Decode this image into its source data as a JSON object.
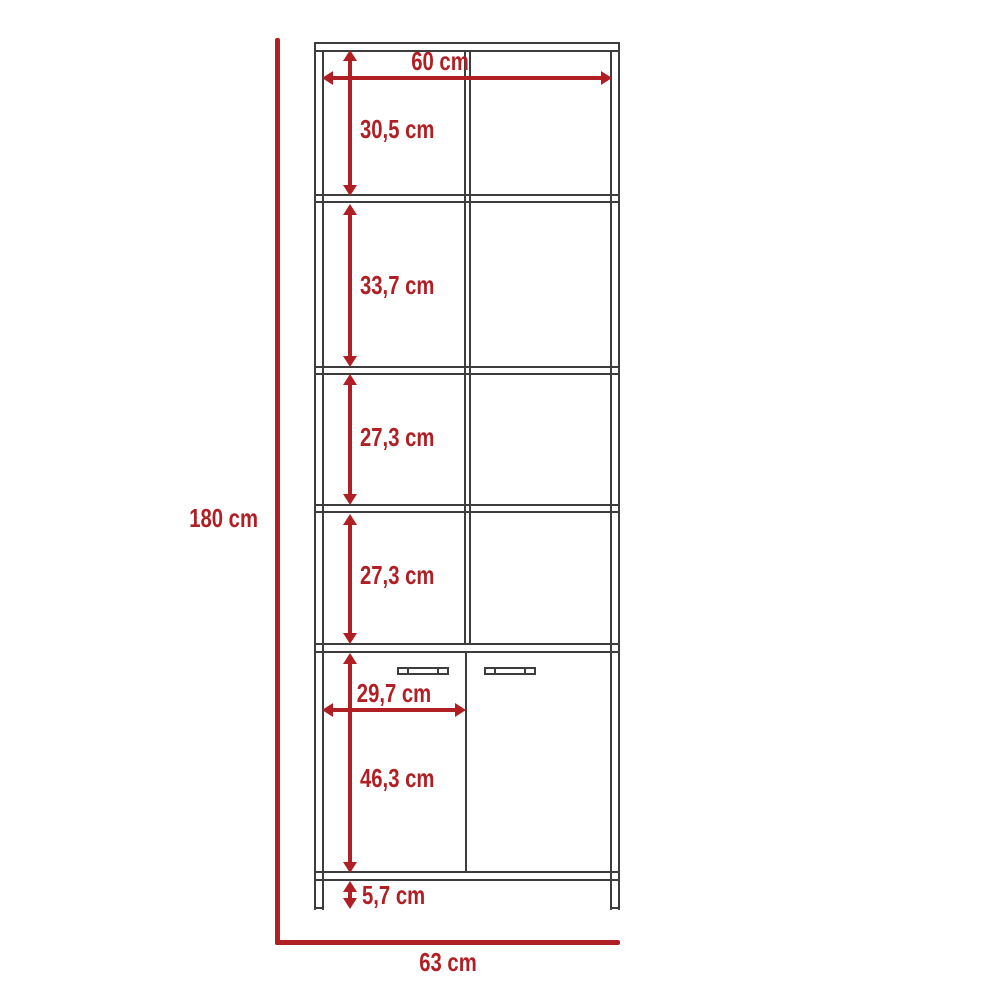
{
  "diagram": {
    "type": "furniture-dimension-drawing",
    "subject": "tall bookcase with four open shelf compartments and a two-door base cabinet on legs",
    "units": "cm",
    "accent_color": "#b01f24",
    "line_color": "#3d3d3d",
    "dimensions": {
      "overall_height": "180 cm",
      "overall_width": "63 cm",
      "inner_width": "60 cm",
      "compartment_1_height": "30,5 cm",
      "compartment_2_height": "33,7 cm",
      "compartment_3_height": "27,3 cm",
      "compartment_4_height": "27,3 cm",
      "door_width": "29,7 cm",
      "door_height": "46,3 cm",
      "leg_height": "5,7 cm"
    }
  }
}
